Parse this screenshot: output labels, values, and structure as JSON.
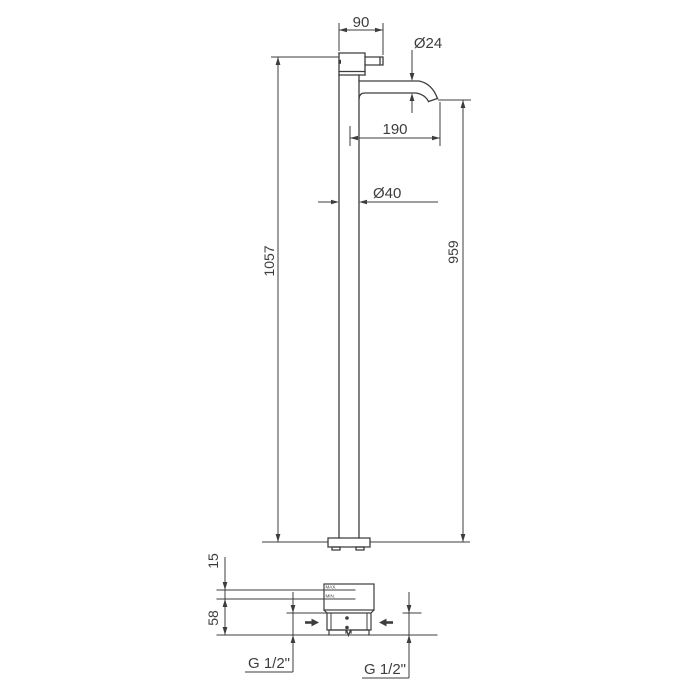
{
  "drawing": {
    "type": "technical-dimension-drawing",
    "subject": "Freestanding floor-mounted single-lever mixer tap, front elevation with floor installation detail",
    "units": "mm",
    "line_color": "#3d3d3d",
    "text_color": "#3d3d3d",
    "background": "#ffffff",
    "dimensions": {
      "handle_width": "90",
      "spout_diameter": "Ø24",
      "spout_reach": "190",
      "column_diameter": "Ø40",
      "total_height": "1057",
      "spout_height": "959",
      "floor_level_range": "15",
      "base_embed_depth": "58",
      "left_connection": "G 1/2\"",
      "right_connection": "G 1/2\""
    },
    "detail_labels": {
      "max": "MAX.",
      "min": "MIN."
    }
  }
}
